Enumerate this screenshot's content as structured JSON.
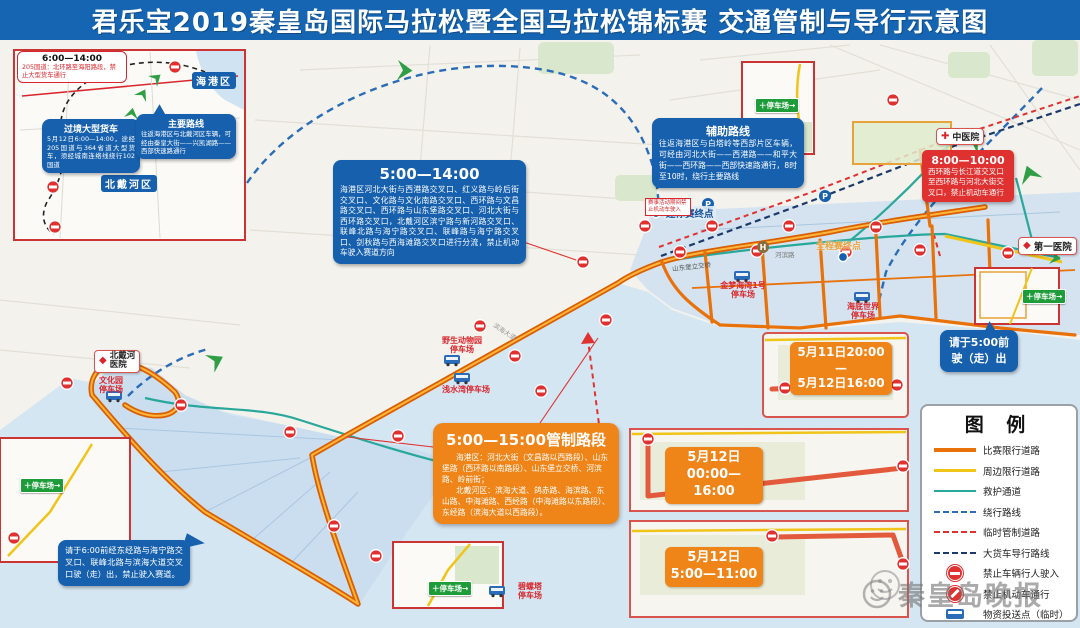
{
  "title": "君乐宝2019秦皇岛国际马拉松暨全国马拉松锦标赛 交通管制与导行示意图",
  "colors": {
    "title_bg": "#1565b2",
    "callout_blue": "#1660ad",
    "control_orange": "#ef8519",
    "alert_red": "#e03131",
    "route_orange": "#e8710a",
    "route_yellow": "#f0c419",
    "rescue_teal": "#2aa79b",
    "detour_blue": "#2b6cb8",
    "truck_navy": "#1b3a6b",
    "sea": "#d5e6f3"
  },
  "inset_tl": {
    "time_box": {
      "time": "6:00—14:00",
      "body": "205国道：北环路至海阳路段，禁止大型货车通行"
    },
    "truck_box": {
      "title": "过境大型货车",
      "body": "5月12日6:00—14:00，途经205国道与364省道大型货车，须经城南连络线绕行102国道"
    },
    "route_box": {
      "title": "主要路线",
      "body": "往返海港区与北戴河区车辆，可经由秦皇大街——兴凯湖路——西部快速路通行"
    },
    "label_haigang": "海港区",
    "label_beidaihe": "北戴河区"
  },
  "callouts": {
    "c514": {
      "time": "5:00—14:00",
      "body": "海港区河北大街与西港路交叉口、红义路与岭后街交叉口、文化路与文化南路交叉口、西环路与文昌路交叉口、西环路与山东堡路交叉口、河北大街与西环路交叉口，北戴河区滨宁路与新河路交叉口、联峰北路与海宁路交叉口、联峰路与海宁路交叉口、剑秋路与西海滩路交叉口进行分流，禁止机动车驶入赛道方向"
    },
    "aux": {
      "title": "辅助路线",
      "body": "往返海港区与白塔岭等西部片区车辆，可经由河北大街——西港路——和平大街——西环路——西部快速路通行，8时至10时，绕行主要路线"
    },
    "r810": {
      "time": "8:00—10:00",
      "body": "西环路与长江道交叉口至西环路与河北大街交叉口，禁止机动车通行"
    },
    "exit_left": "请于6:00前经东经路与海宁路交叉口、联峰北路与滨海大道交叉口驶（走）出，禁止驶入赛道。",
    "exit_right": "请于5:00前\n驶（走）出"
  },
  "control_box": {
    "title": "5:00—15:00管制路段",
    "p1": "海港区：河北大街（文昌路以西路段）、山东堡路（西环路以南路段）、山东堡立交桥、河滨路、岭前街；",
    "p2": "北戴河区：滨海大道、鸽赤路、海滨路、东山路、中海滩路、西经路（中海滩路以东路段）、东经路（滨海大道以西路段）。"
  },
  "panels": {
    "p1": {
      "label": "5月11日20:00—\n5月12日16:00"
    },
    "p2": {
      "label": "5月12日\n00:00—16:00"
    },
    "p3": {
      "label": "5月12日\n5:00—11:00"
    }
  },
  "legend": {
    "title": "图 例",
    "items": [
      {
        "label": "比赛限行道路"
      },
      {
        "label": "周边限行道路"
      },
      {
        "label": "救护通道"
      },
      {
        "label": "绕行路线"
      },
      {
        "label": "临时管制道路"
      },
      {
        "label": "大货车导行路线"
      },
      {
        "label": "禁止车辆行人驶入"
      },
      {
        "label": "禁止机动车通行"
      },
      {
        "label": "物资投送点（临时）"
      }
    ]
  },
  "map_labels": {
    "parking": [
      {
        "text": "野生动物园\n停车场"
      },
      {
        "text": "浅水湾停车场"
      },
      {
        "text": "金梦海湾1号\n停车场"
      },
      {
        "text": "海底世界\n停车场"
      },
      {
        "text": "文化园\n停车场"
      },
      {
        "text": "碧螺塔\n停车场"
      }
    ],
    "hospitals": [
      {
        "text": "北戴河\n医院"
      },
      {
        "text": "中医院"
      },
      {
        "text": "第一医院"
      }
    ],
    "finish": [
      {
        "text": "迷你赛终点"
      },
      {
        "text": "全程赛终点"
      }
    ],
    "roads": [
      {
        "text": "山东堡立交桥"
      },
      {
        "text": "河滨路"
      },
      {
        "text": "滨海大道"
      }
    ],
    "notice": "赛事活动期间禁止机动车驶入",
    "parking_sign": "＋停车场→"
  },
  "icons": {
    "p": "P",
    "h": "H",
    "diamond": "◆",
    "cross": "✚"
  },
  "watermark": {
    "text": "秦皇岛晚报"
  }
}
